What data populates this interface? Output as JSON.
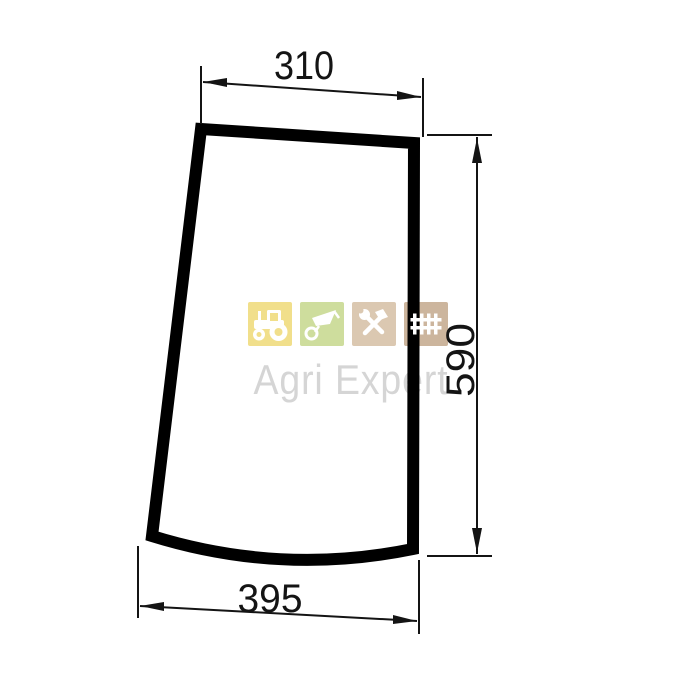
{
  "page": {
    "background": "#ffffff"
  },
  "drawing": {
    "type": "technical-dimension-drawing",
    "subject": "curved trapezoidal glass panel outline",
    "line_color": "#000000",
    "dimensions": {
      "top_width": "310",
      "right_height": "590",
      "bottom_width": "395"
    }
  },
  "watermark": {
    "brand": "Agri Expert",
    "text_color": "#d5d5d5",
    "tiles": [
      {
        "icon": "tractor-icon",
        "color": "#f1df8b"
      },
      {
        "icon": "wheelbarrow-icon",
        "color": "#cedd9d"
      },
      {
        "icon": "tools-icon",
        "color": "#dbc8b1"
      },
      {
        "icon": "fence-icon",
        "color": "#ccb59d"
      }
    ]
  }
}
